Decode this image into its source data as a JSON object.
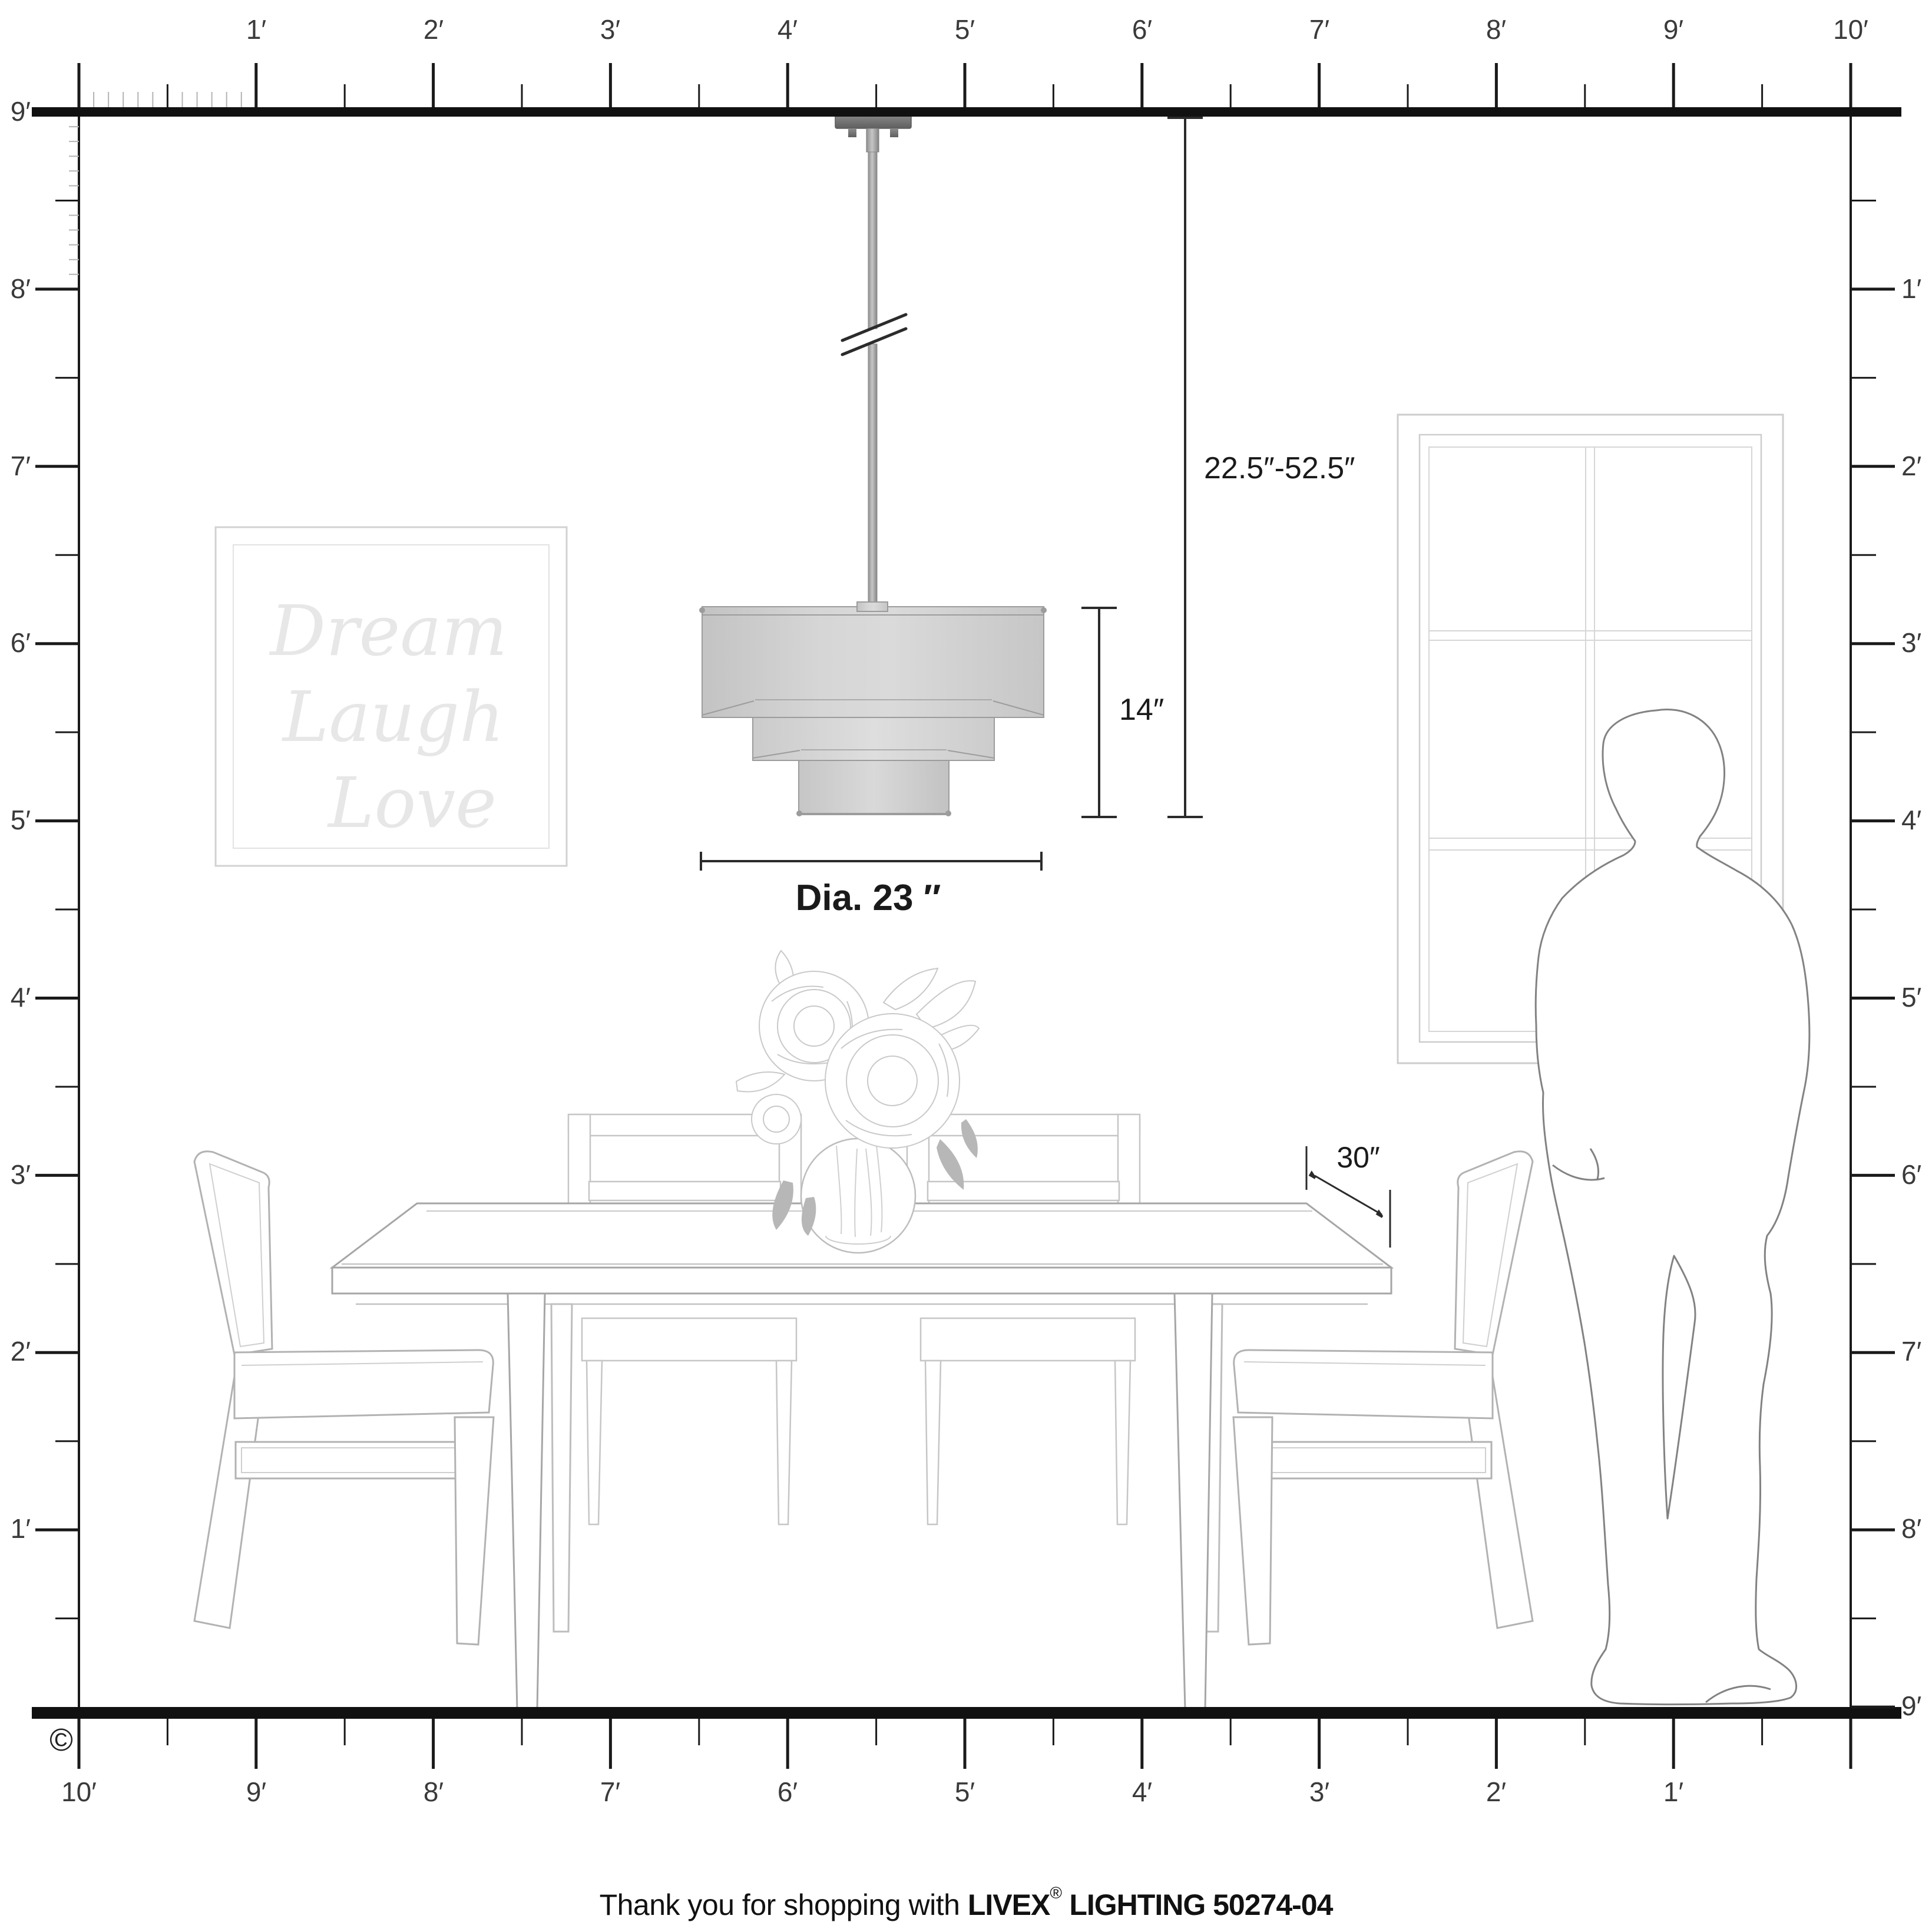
{
  "copyright": "©",
  "caption": {
    "prefix": "Thank you for shopping with ",
    "brand": "LIVEX",
    "registered": "®",
    "suffix": " LIGHTING 50274-04"
  },
  "dimensions": {
    "hang_range": "22.5″-52.5″",
    "fixture_height": "14″",
    "diameter_label": "Dia. 23 ″",
    "table_clearance": "30″"
  },
  "wall_art": {
    "line1": "Dream",
    "line2": "Laugh",
    "line3": "Love"
  },
  "rulers": {
    "top": {
      "labels": [
        "1′",
        "2′",
        "3′",
        "4′",
        "5′",
        "6′",
        "7′",
        "8′",
        "9′",
        "10′"
      ]
    },
    "bottom": {
      "labels": [
        "10′",
        "9′",
        "8′",
        "7′",
        "6′",
        "5′",
        "4′",
        "3′",
        "2′",
        "1′"
      ]
    },
    "left": {
      "labels": [
        "9′",
        "8′",
        "7′",
        "6′",
        "5′",
        "4′",
        "3′",
        "2′",
        "1′"
      ]
    },
    "right": {
      "labels": [
        "1′",
        "2′",
        "3′",
        "4′",
        "5′",
        "6′",
        "7′",
        "8′",
        "9′"
      ]
    }
  }
}
